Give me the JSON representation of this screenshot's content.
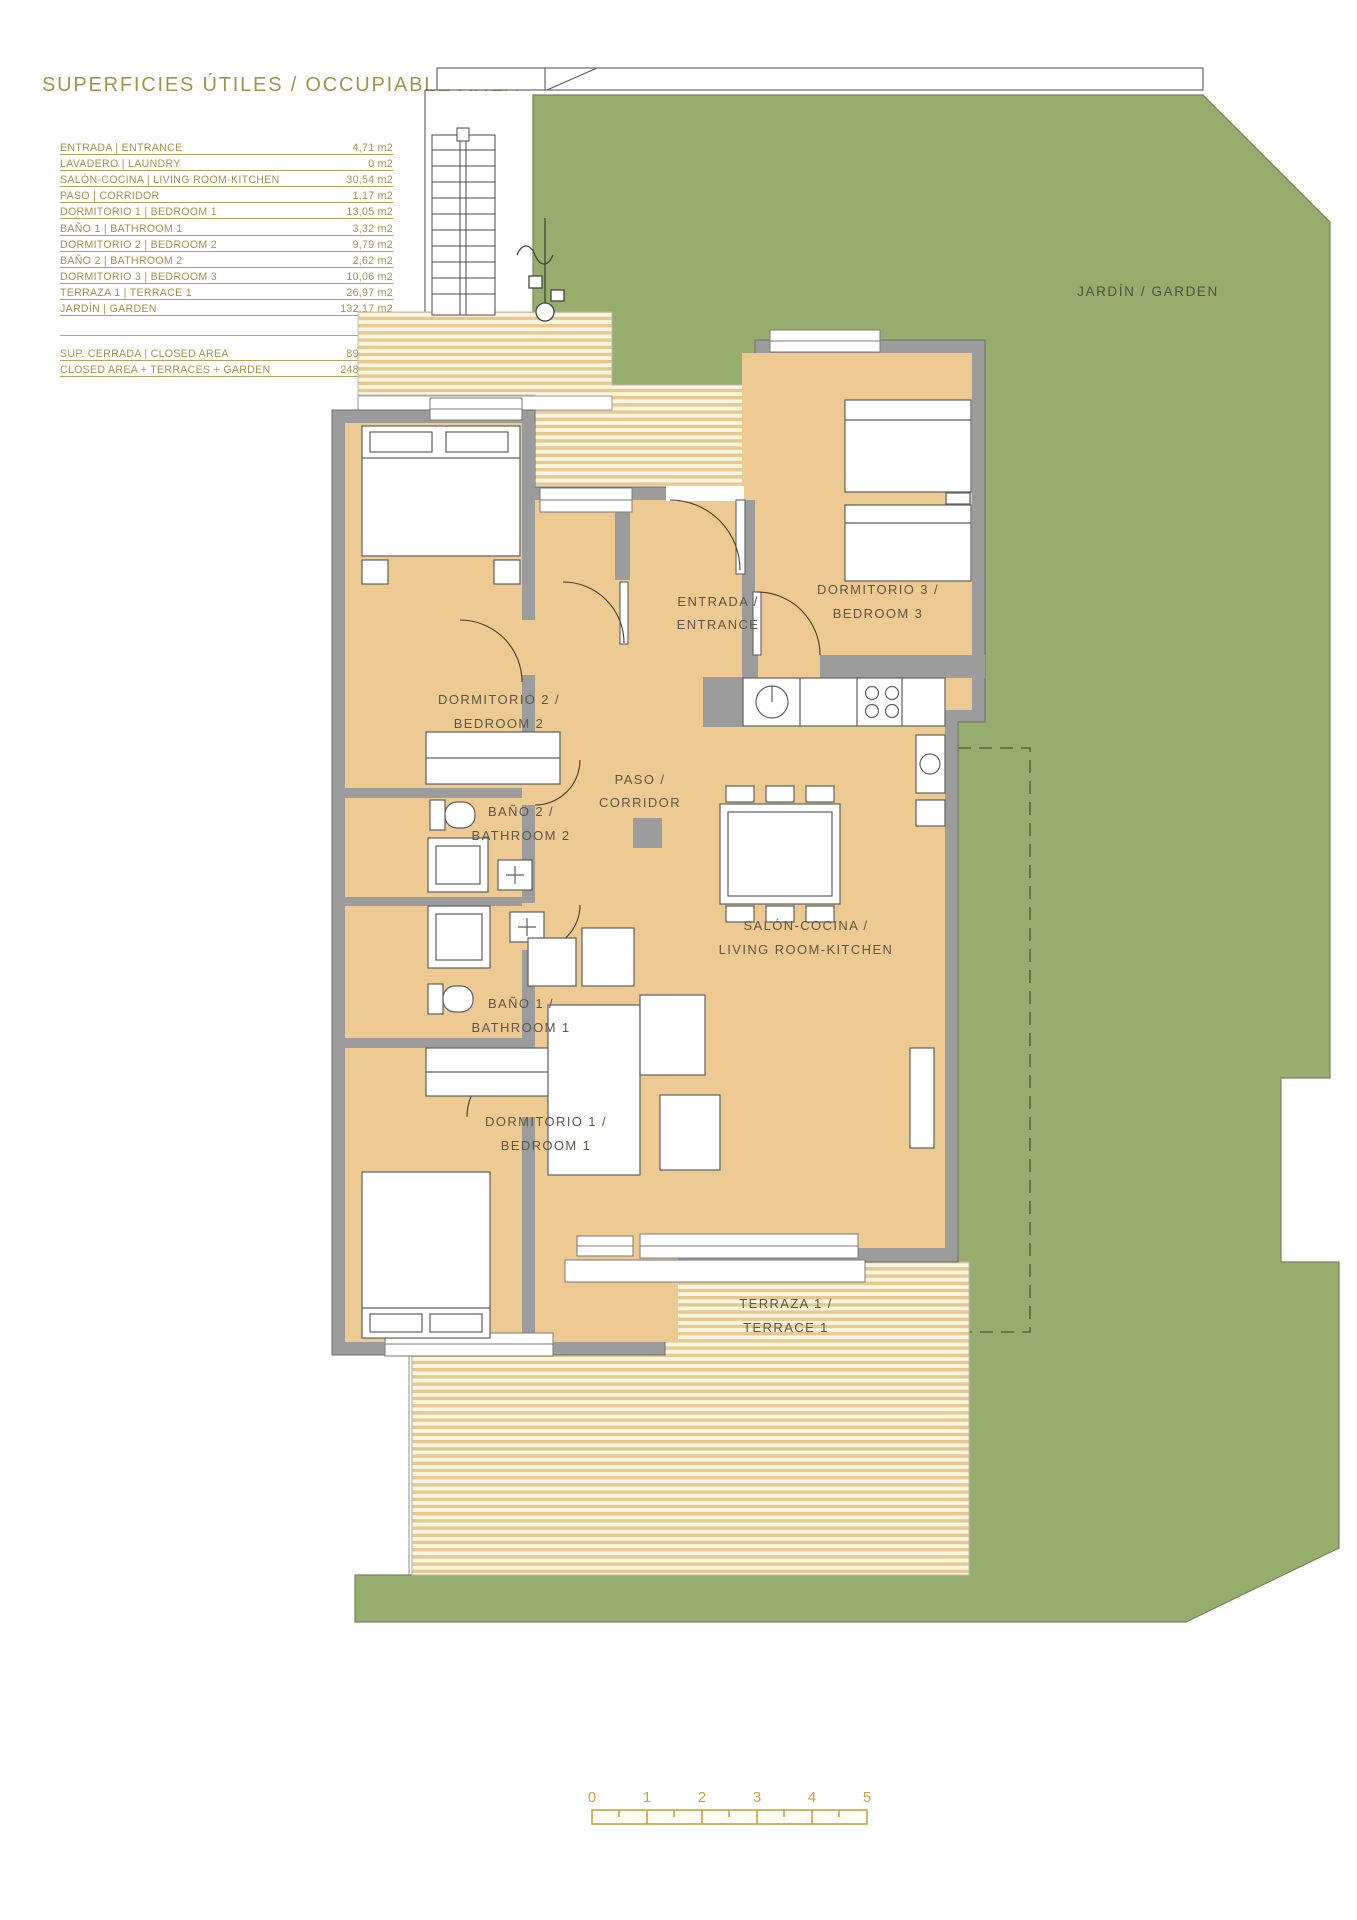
{
  "title": "SUPERFICIES ÚTILES / OCCUPIABLE AREA",
  "area_table": {
    "rows": [
      {
        "label": "ENTRADA | ENTRANCE",
        "value": "4,71 m2"
      },
      {
        "label": "LAVADERO | LAUNDRY",
        "value": "0 m2"
      },
      {
        "label": "SALÓN-COCINA | LIVING ROOM-KITCHEN",
        "value": "30,54 m2"
      },
      {
        "label": "PASO | CORRIDOR",
        "value": "1,17 m2"
      },
      {
        "label": "DORMITORIO 1 | BEDROOM 1",
        "value": "13,05 m2"
      },
      {
        "label": "BAÑO 1 | BATHROOM 1",
        "value": "3,32 m2"
      },
      {
        "label": "DORMITORIO 2 | BEDROOM 2",
        "value": "9,79 m2"
      },
      {
        "label": "BAÑO 2 | BATHROOM 2",
        "value": "2,62 m2"
      },
      {
        "label": "DORMITORIO 3 | BEDROOM 3",
        "value": "10,06 m2"
      },
      {
        "label": "TERRAZA 1 | TERRACE 1",
        "value": "26,97 m2"
      },
      {
        "label": "JARDÍN | GARDEN",
        "value": "132,17 m2"
      }
    ],
    "summary": [
      {
        "label": "SUP. CERRADA | CLOSED AREA",
        "value": "89,85 m2"
      },
      {
        "label": "CLOSED AREA + TERRACES + GARDEN",
        "value": "248,99 m2"
      }
    ]
  },
  "plan": {
    "garden_label": "JARDÍN / GARDEN",
    "rooms": {
      "entrance": {
        "line1": "ENTRADA /",
        "line2": "ENTRANCE"
      },
      "bedroom3": {
        "line1": "DORMITORIO 3 /",
        "line2": "BEDROOM 3"
      },
      "bedroom2": {
        "line1": "DORMITORIO 2 /",
        "line2": "BEDROOM 2"
      },
      "corridor": {
        "line1": "PASO /",
        "line2": "CORRIDOR"
      },
      "bathroom2": {
        "line1": "BAÑO 2 /",
        "line2": "BATHROOM 2"
      },
      "bathroom1": {
        "line1": "BAÑO 1 /",
        "line2": "BATHROOM 1"
      },
      "living": {
        "line1": "SALÓN-COCINA /",
        "line2": "LIVING ROOM-KITCHEN"
      },
      "bedroom1": {
        "line1": "DORMITORIO 1 /",
        "line2": "BEDROOM 1"
      },
      "terrace1": {
        "line1": "TERRAZA 1 /",
        "line2": "TERRACE 1"
      }
    }
  },
  "scale_bar": {
    "ticks": [
      "0",
      "1",
      "2",
      "3",
      "4",
      "5"
    ]
  },
  "colors": {
    "accent_gold": "#a3924c",
    "scale_gold": "#c9a23f",
    "garden_green": "#97ad6e",
    "room_tan": "#ecca92",
    "wall_gray": "#9c9c9c"
  }
}
